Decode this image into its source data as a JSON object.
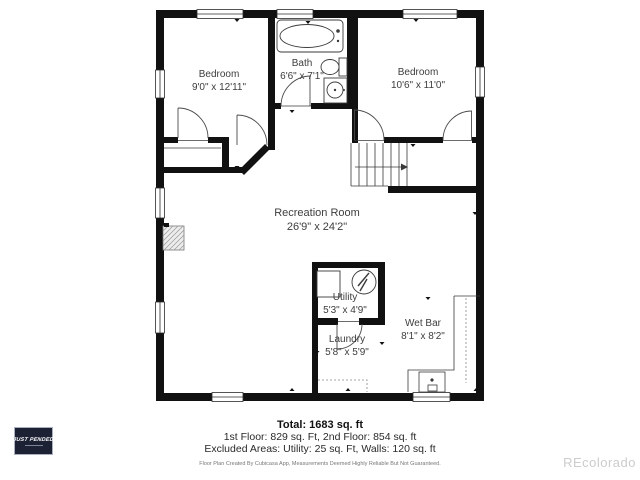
{
  "floor_plan": {
    "rooms": [
      {
        "name": "Bedroom",
        "dims": "9'0\" x 12'11\""
      },
      {
        "name": "Bath",
        "dims": "6'6\" x 7'1\""
      },
      {
        "name": "Bedroom",
        "dims": "10'6\" x 11'0\""
      },
      {
        "name": "Recreation Room",
        "dims": "26'9\" x 24'2\""
      },
      {
        "name": "Utility",
        "dims": "5'3\" x 4'9\""
      },
      {
        "name": "Laundry",
        "dims": "5'8\" x 5'9\""
      },
      {
        "name": "Wet Bar",
        "dims": "8'1\" x 8'2\""
      }
    ],
    "fixtures": [
      "bathtub-icon",
      "toilet-icon",
      "sink-icon",
      "water-heater-icon",
      "furnace-icon",
      "staircase",
      "wet-bar-counter",
      "fireplace-hatch"
    ],
    "colors": {
      "wall": "#111111",
      "label_text": "#3d3d3d",
      "stamp_bg": "#1c2134",
      "stamp_text": "#ffffff",
      "watermark_text": "#cccccc"
    }
  },
  "summary": {
    "total": "Total: 1683 sq. ft",
    "floors": "1st Floor: 829 sq. Ft, 2nd Floor: 854 sq. ft",
    "excluded": "Excluded Areas: Utility: 25 sq. Ft, Walls: 120 sq. ft",
    "disclaimer": "Floor Plan Created By Cubicasa App, Measurements Deemed Highly Reliable But Not Guaranteed."
  },
  "stamp": {
    "label": "JUST PENDED"
  },
  "watermark": {
    "label": "REcolorado"
  }
}
